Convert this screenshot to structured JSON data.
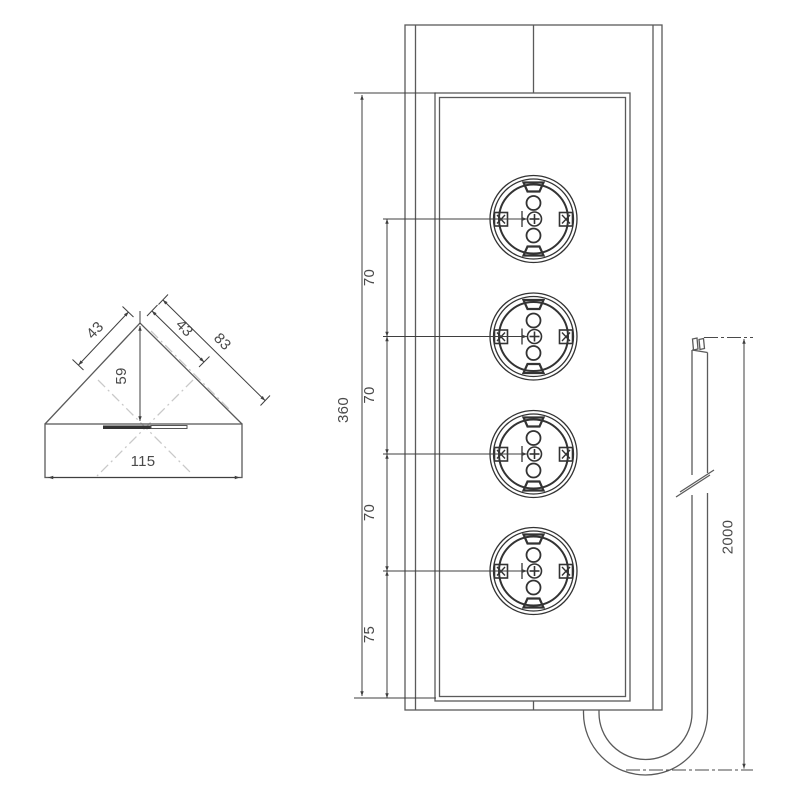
{
  "drawing": {
    "title": "Corner power strip — dimensional drawing",
    "side_view": {
      "dim_left_segment": "43",
      "dim_right_segment": "43",
      "dim_right_edge": "83",
      "dim_height": "59",
      "dim_width": "115"
    },
    "front_view": {
      "socket_count": 4,
      "dim_total": "360",
      "dim_spacings": [
        "70",
        "70",
        "70"
      ],
      "dim_bottom": "75"
    },
    "cable": {
      "dim_length": "2000"
    },
    "colors": {
      "line": "#5a5a5a",
      "detail": "#333333",
      "dim_text": "#4a4a4a",
      "centerline": "#c9c9c9",
      "background": "#ffffff"
    }
  }
}
